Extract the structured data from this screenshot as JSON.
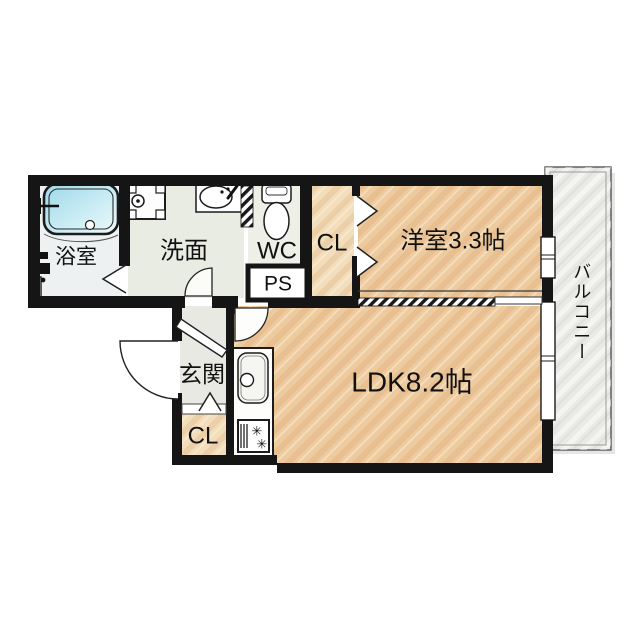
{
  "plan": {
    "title": "1LDK apartment floor plan",
    "rooms": {
      "bathroom": {
        "label": "浴室"
      },
      "washroom": {
        "label": "洗面"
      },
      "wc": {
        "label": "WC"
      },
      "pipe_space": {
        "label": "PS"
      },
      "closet_upper": {
        "label": "CL"
      },
      "western_room": {
        "label": "洋室3.3帖"
      },
      "ldk": {
        "label": "LDK8.2帖"
      },
      "entrance": {
        "label": "玄関"
      },
      "closet_entrance": {
        "label": "CL"
      },
      "balcony": {
        "label": "バルコニー"
      }
    },
    "icons": {
      "stove_burner_glyph": "✳"
    },
    "colors": {
      "wall": "#151515",
      "wood_floor": "#edcb9f",
      "closet_floor": "#f3debc",
      "bathroom_floor": "#edf1f1",
      "washroom_floor": "#e9ece3",
      "wc_floor": "#eef0e8",
      "entrance_floor": "#e9e9e4",
      "balcony": "#e9e9e5",
      "bath_water": "#aadcec",
      "background": "#ffffff"
    }
  }
}
